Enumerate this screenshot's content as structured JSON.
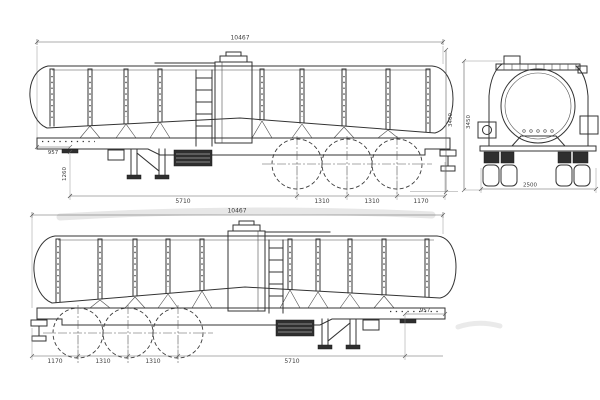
{
  "meta": {
    "paper_bg": "#ffffff",
    "line_color": "#333333",
    "dim_text_color": "#3c3c3c",
    "watermark_color": "#e3e3e3",
    "drawing_type": "tanker-semi-trailer-blueprint"
  },
  "side_view_top": {
    "overall_length": "10467",
    "front_overhang": "957",
    "kingpin_height": "1260",
    "wheelbase": "5710",
    "axle_spacing_1": "1310",
    "axle_spacing_2": "1310",
    "rear_overhang": "1170",
    "overall_height": "3460"
  },
  "rear_view": {
    "overall_width": "2500",
    "overall_height": "3450"
  },
  "side_view_bottom": {
    "overall_length": "10467",
    "rear_overhang": "1170",
    "axle_spacing_1": "1310",
    "axle_spacing_2": "1310",
    "wheelbase": "5710",
    "front_overhang": "957"
  }
}
